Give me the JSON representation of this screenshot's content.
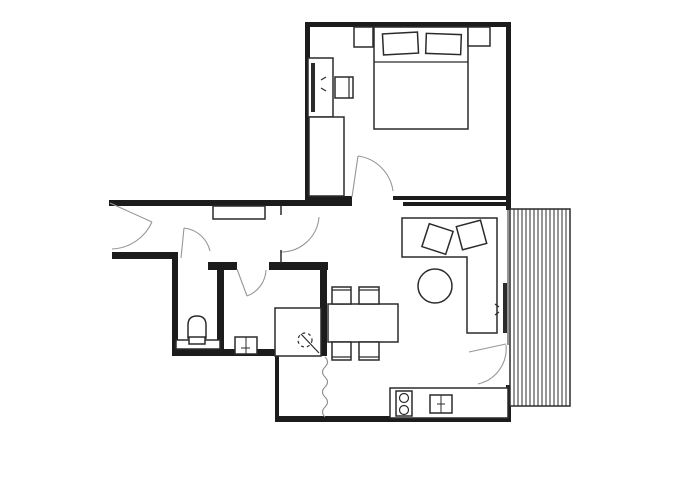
{
  "canvas": {
    "width": 700,
    "height": 500,
    "background": "#ffffff"
  },
  "palette": {
    "wall": "#1c1c1c",
    "furniture_stroke": "#2b2b2b",
    "door_arc": "#979797",
    "break_line": "#8f8f8f",
    "fill": "#ffffff"
  },
  "plan": {
    "elements": [
      {
        "t": "wall",
        "name": "wall-bedroom-top",
        "x": 305,
        "y": 22,
        "w": 206,
        "h": 5
      },
      {
        "t": "wall",
        "name": "wall-bedroom-left",
        "x": 305,
        "y": 22,
        "w": 5,
        "h": 183
      },
      {
        "t": "wall",
        "name": "wall-bedroom-right",
        "x": 506,
        "y": 22,
        "w": 5,
        "h": 188
      },
      {
        "t": "wall",
        "name": "wall-hall-top",
        "x": 109,
        "y": 200,
        "w": 243,
        "h": 6
      },
      {
        "t": "wall",
        "name": "wall-bedroom-door-stub",
        "x": 305,
        "y": 196,
        "w": 47,
        "h": 8
      },
      {
        "t": "wall",
        "name": "wall-bedroom-bottom",
        "x": 393,
        "y": 196,
        "w": 118,
        "h": 4
      },
      {
        "t": "wall",
        "name": "wall-living-top",
        "x": 403,
        "y": 202,
        "w": 108,
        "h": 4
      },
      {
        "t": "wall",
        "name": "wall-hall-bottom",
        "x": 112,
        "y": 252,
        "w": 63,
        "h": 7
      },
      {
        "t": "wall",
        "name": "wall-bath-left",
        "x": 172,
        "y": 252,
        "w": 6,
        "h": 104
      },
      {
        "t": "wall",
        "name": "wall-bath-bottom",
        "x": 172,
        "y": 349,
        "w": 152,
        "h": 7
      },
      {
        "t": "wall",
        "name": "wall-bath-tee-cap",
        "x": 208,
        "y": 262,
        "w": 29,
        "h": 8
      },
      {
        "t": "wall",
        "name": "wall-bath-tee-stem",
        "x": 217,
        "y": 270,
        "w": 7,
        "h": 80
      },
      {
        "t": "wall",
        "name": "wall-shower-room-top",
        "x": 269,
        "y": 262,
        "w": 59,
        "h": 8
      },
      {
        "t": "wall",
        "name": "wall-core-right",
        "x": 320,
        "y": 266,
        "w": 7,
        "h": 90
      },
      {
        "t": "wall",
        "name": "wall-kitchen-nook-left",
        "x": 275,
        "y": 356,
        "w": 4,
        "h": 65
      },
      {
        "t": "wall",
        "name": "wall-plan-bottom",
        "x": 275,
        "y": 416,
        "w": 236,
        "h": 6
      },
      {
        "t": "wall",
        "name": "wall-kitchen-right",
        "x": 506,
        "y": 385,
        "w": 5,
        "h": 37
      },
      {
        "t": "line",
        "name": "window-wall-upper",
        "x1": 508,
        "y1": 210,
        "x2": 508,
        "y2": 345,
        "sw": 1
      },
      {
        "t": "line",
        "name": "window-wall-lower",
        "x1": 508,
        "y1": 385,
        "x2": 508,
        "y2": 416,
        "sw": 1
      },
      {
        "t": "rect",
        "name": "balcony-deck",
        "x": 510,
        "y": 209,
        "w": 60,
        "h": 197,
        "sw": 1.5
      },
      {
        "t": "stripes",
        "name": "balcony-deck-boards",
        "x0": 514,
        "x1": 567,
        "step": 4,
        "y0": 209,
        "y1": 406,
        "sw": 1
      },
      {
        "t": "rect",
        "name": "bed",
        "x": 374,
        "y": 27,
        "w": 94,
        "h": 102
      },
      {
        "t": "line",
        "name": "bed-blanket-line",
        "x1": 374,
        "y1": 62,
        "x2": 468,
        "y2": 62,
        "sw": 1.2
      },
      {
        "t": "rect",
        "name": "pillow-left",
        "x": 383,
        "y": 33,
        "w": 35,
        "h": 21,
        "rot": -3
      },
      {
        "t": "rect",
        "name": "pillow-right",
        "x": 426,
        "y": 34,
        "w": 35,
        "h": 20,
        "rot": 2
      },
      {
        "t": "rect",
        "name": "nightstand-left",
        "x": 354,
        "y": 27,
        "w": 19,
        "h": 20
      },
      {
        "t": "rect",
        "name": "nightstand-right",
        "x": 468,
        "y": 27,
        "w": 22,
        "h": 19
      },
      {
        "t": "rect",
        "name": "bedroom-dresser",
        "x": 308,
        "y": 58,
        "w": 25,
        "h": 59
      },
      {
        "t": "frect",
        "name": "bedroom-tv",
        "x": 311,
        "y": 63,
        "w": 4,
        "h": 49
      },
      {
        "t": "line",
        "name": "bedroom-tv-signal-mark-1",
        "x1": 326,
        "y1": 77,
        "x2": 321,
        "y2": 80,
        "sw": 1.2
      },
      {
        "t": "line",
        "name": "bedroom-tv-signal-mark-2",
        "x1": 326,
        "y1": 91,
        "x2": 321,
        "y2": 88,
        "sw": 1.2
      },
      {
        "t": "rect",
        "name": "bedroom-stool",
        "x": 335,
        "y": 77,
        "w": 18,
        "h": 21
      },
      {
        "t": "line",
        "name": "bedroom-stool-back",
        "x1": 349,
        "y1": 77,
        "x2": 349,
        "y2": 98,
        "sw": 1.2
      },
      {
        "t": "rect",
        "name": "bedroom-wardrobe",
        "x": 309,
        "y": 117,
        "w": 35,
        "h": 79
      },
      {
        "t": "path",
        "name": "sofa",
        "d": "M402,218 H497 V333 H467 V257 H402 Z",
        "fill": true
      },
      {
        "t": "rect",
        "name": "sofa-cushion-left",
        "x": 425,
        "y": 227,
        "w": 25,
        "h": 24,
        "rot": 18
      },
      {
        "t": "rect",
        "name": "sofa-cushion-right",
        "x": 459,
        "y": 223,
        "w": 25,
        "h": 24,
        "rot": -15
      },
      {
        "t": "circle",
        "name": "coffee-table",
        "cx": 435,
        "cy": 286,
        "r": 17
      },
      {
        "t": "frect",
        "name": "living-tv",
        "x": 503,
        "y": 283,
        "w": 4,
        "h": 50
      },
      {
        "t": "line",
        "name": "living-tv-signal-mark-1",
        "x1": 495,
        "y1": 304,
        "x2": 499,
        "y2": 307,
        "sw": 1.2
      },
      {
        "t": "line",
        "name": "living-tv-signal-mark-2",
        "x1": 495,
        "y1": 315,
        "x2": 499,
        "y2": 312,
        "sw": 1.2
      },
      {
        "t": "rect",
        "name": "dining-table",
        "x": 328,
        "y": 304,
        "w": 70,
        "h": 38
      },
      {
        "t": "rect",
        "name": "dining-chair-top-left",
        "x": 332,
        "y": 287,
        "w": 19,
        "h": 17
      },
      {
        "t": "line",
        "name": "dining-chair-top-left-back",
        "x1": 332,
        "y1": 290,
        "x2": 351,
        "y2": 290,
        "sw": 1.2
      },
      {
        "t": "rect",
        "name": "dining-chair-top-right",
        "x": 359,
        "y": 287,
        "w": 20,
        "h": 17
      },
      {
        "t": "line",
        "name": "dining-chair-top-right-back",
        "x1": 359,
        "y1": 290,
        "x2": 379,
        "y2": 290,
        "sw": 1.2
      },
      {
        "t": "rect",
        "name": "dining-chair-bottom-left",
        "x": 332,
        "y": 342,
        "w": 19,
        "h": 18
      },
      {
        "t": "line",
        "name": "dining-chair-bottom-left-back",
        "x1": 332,
        "y1": 357,
        "x2": 351,
        "y2": 357,
        "sw": 1.2
      },
      {
        "t": "rect",
        "name": "dining-chair-bottom-right",
        "x": 359,
        "y": 342,
        "w": 20,
        "h": 18
      },
      {
        "t": "line",
        "name": "dining-chair-bottom-right-back",
        "x1": 359,
        "y1": 357,
        "x2": 379,
        "y2": 357,
        "sw": 1.2
      },
      {
        "t": "rect",
        "name": "hallway-shelf",
        "x": 213,
        "y": 206,
        "w": 52,
        "h": 13
      },
      {
        "t": "rect",
        "name": "toilet-ledge",
        "x": 176,
        "y": 340,
        "w": 44,
        "h": 9
      },
      {
        "t": "path",
        "name": "toilet",
        "d": "M188,338 V325 Q188,316 197,316 Q206,316 206,325 V338 Z",
        "fill": true
      },
      {
        "t": "rect",
        "name": "toilet-base",
        "x": 189,
        "y": 337,
        "w": 16,
        "h": 7
      },
      {
        "t": "rect",
        "name": "bathroom-basin",
        "x": 235,
        "y": 337,
        "w": 22,
        "h": 17
      },
      {
        "t": "line",
        "name": "bathroom-basin-divider",
        "x1": 246,
        "y1": 337,
        "x2": 246,
        "y2": 354,
        "sw": 1
      },
      {
        "t": "line",
        "name": "bathroom-basin-tap",
        "x1": 241,
        "y1": 348,
        "x2": 250,
        "y2": 348,
        "sw": 1
      },
      {
        "t": "rect",
        "name": "shower-enclosure",
        "x": 275,
        "y": 308,
        "w": 46,
        "h": 48
      },
      {
        "t": "line",
        "name": "shower-diagonal",
        "x1": 301,
        "y1": 334,
        "x2": 319,
        "y2": 353,
        "sw": 1.2
      },
      {
        "t": "dcircle",
        "name": "shower-drain-symbol",
        "cx": 305,
        "cy": 340,
        "r": 7
      },
      {
        "t": "rect",
        "name": "kitchen-counter",
        "x": 390,
        "y": 388,
        "w": 118,
        "h": 30
      },
      {
        "t": "rect",
        "name": "kitchen-stove",
        "x": 396,
        "y": 391,
        "w": 16,
        "h": 25
      },
      {
        "t": "circle",
        "name": "stove-burner-top",
        "cx": 404,
        "cy": 398,
        "r": 4.5,
        "sw": 1.2
      },
      {
        "t": "circle",
        "name": "stove-burner-bottom",
        "cx": 404,
        "cy": 410,
        "r": 4.5,
        "sw": 1.2
      },
      {
        "t": "rect",
        "name": "kitchen-sink",
        "x": 430,
        "y": 395,
        "w": 22,
        "h": 18
      },
      {
        "t": "line",
        "name": "kitchen-sink-divider",
        "x1": 441,
        "y1": 395,
        "x2": 441,
        "y2": 413,
        "sw": 1
      },
      {
        "t": "line",
        "name": "kitchen-sink-tap",
        "x1": 437,
        "y1": 404,
        "x2": 445,
        "y2": 404,
        "sw": 1
      },
      {
        "t": "line",
        "name": "entrance-door-leaf",
        "x1": 110,
        "y1": 203,
        "x2": 152,
        "y2": 222,
        "c": "d",
        "sw": 1.1
      },
      {
        "t": "path",
        "name": "entrance-door-arc",
        "d": "M152,222 A46,46 0 0 1 112,249",
        "c": "d"
      },
      {
        "t": "line",
        "name": "dining-door-jamb",
        "x1": 281,
        "y1": 206,
        "x2": 281,
        "y2": 215,
        "sw": 1.5
      },
      {
        "t": "path",
        "name": "dining-door-arc",
        "d": "M319,217 A38,38 0 0 1 281,252",
        "c": "d"
      },
      {
        "t": "line",
        "name": "dining-door-leaf",
        "x1": 281,
        "y1": 250,
        "x2": 281,
        "y2": 263,
        "sw": 1.5
      },
      {
        "t": "line",
        "name": "toilet-door-leaf",
        "x1": 181,
        "y1": 258,
        "x2": 184,
        "y2": 228,
        "c": "d",
        "sw": 1.1
      },
      {
        "t": "path",
        "name": "toilet-door-arc",
        "d": "M184,228 A30,30 0 0 1 210,251",
        "c": "d"
      },
      {
        "t": "line",
        "name": "shower-room-door-leaf",
        "x1": 237,
        "y1": 269,
        "x2": 247,
        "y2": 296,
        "c": "d",
        "sw": 1.1
      },
      {
        "t": "path",
        "name": "shower-room-door-arc",
        "d": "M247,296 A29,29 0 0 0 266,270",
        "c": "d"
      },
      {
        "t": "line",
        "name": "bedroom-door-leaf",
        "x1": 352,
        "y1": 197,
        "x2": 358,
        "y2": 156,
        "c": "d",
        "sw": 1.1
      },
      {
        "t": "path",
        "name": "bedroom-door-arc",
        "d": "M358,156 A41,41 0 0 1 393,191",
        "c": "d"
      },
      {
        "t": "line",
        "name": "balcony-door-leaf",
        "x1": 506,
        "y1": 344,
        "x2": 469,
        "y2": 352,
        "c": "d",
        "sw": 1.1
      },
      {
        "t": "path",
        "name": "balcony-door-arc",
        "d": "M506,345 A36,36 0 0 1 478,384",
        "c": "d"
      },
      {
        "t": "path",
        "name": "kitchen-break-line",
        "d": "M325,357 q5,5 0,10 q-5,5 0,10 q5,5 0,10 q-5,5 0,10 q5,5 0,10 q-5,5 0,10",
        "c": "b"
      }
    ]
  }
}
